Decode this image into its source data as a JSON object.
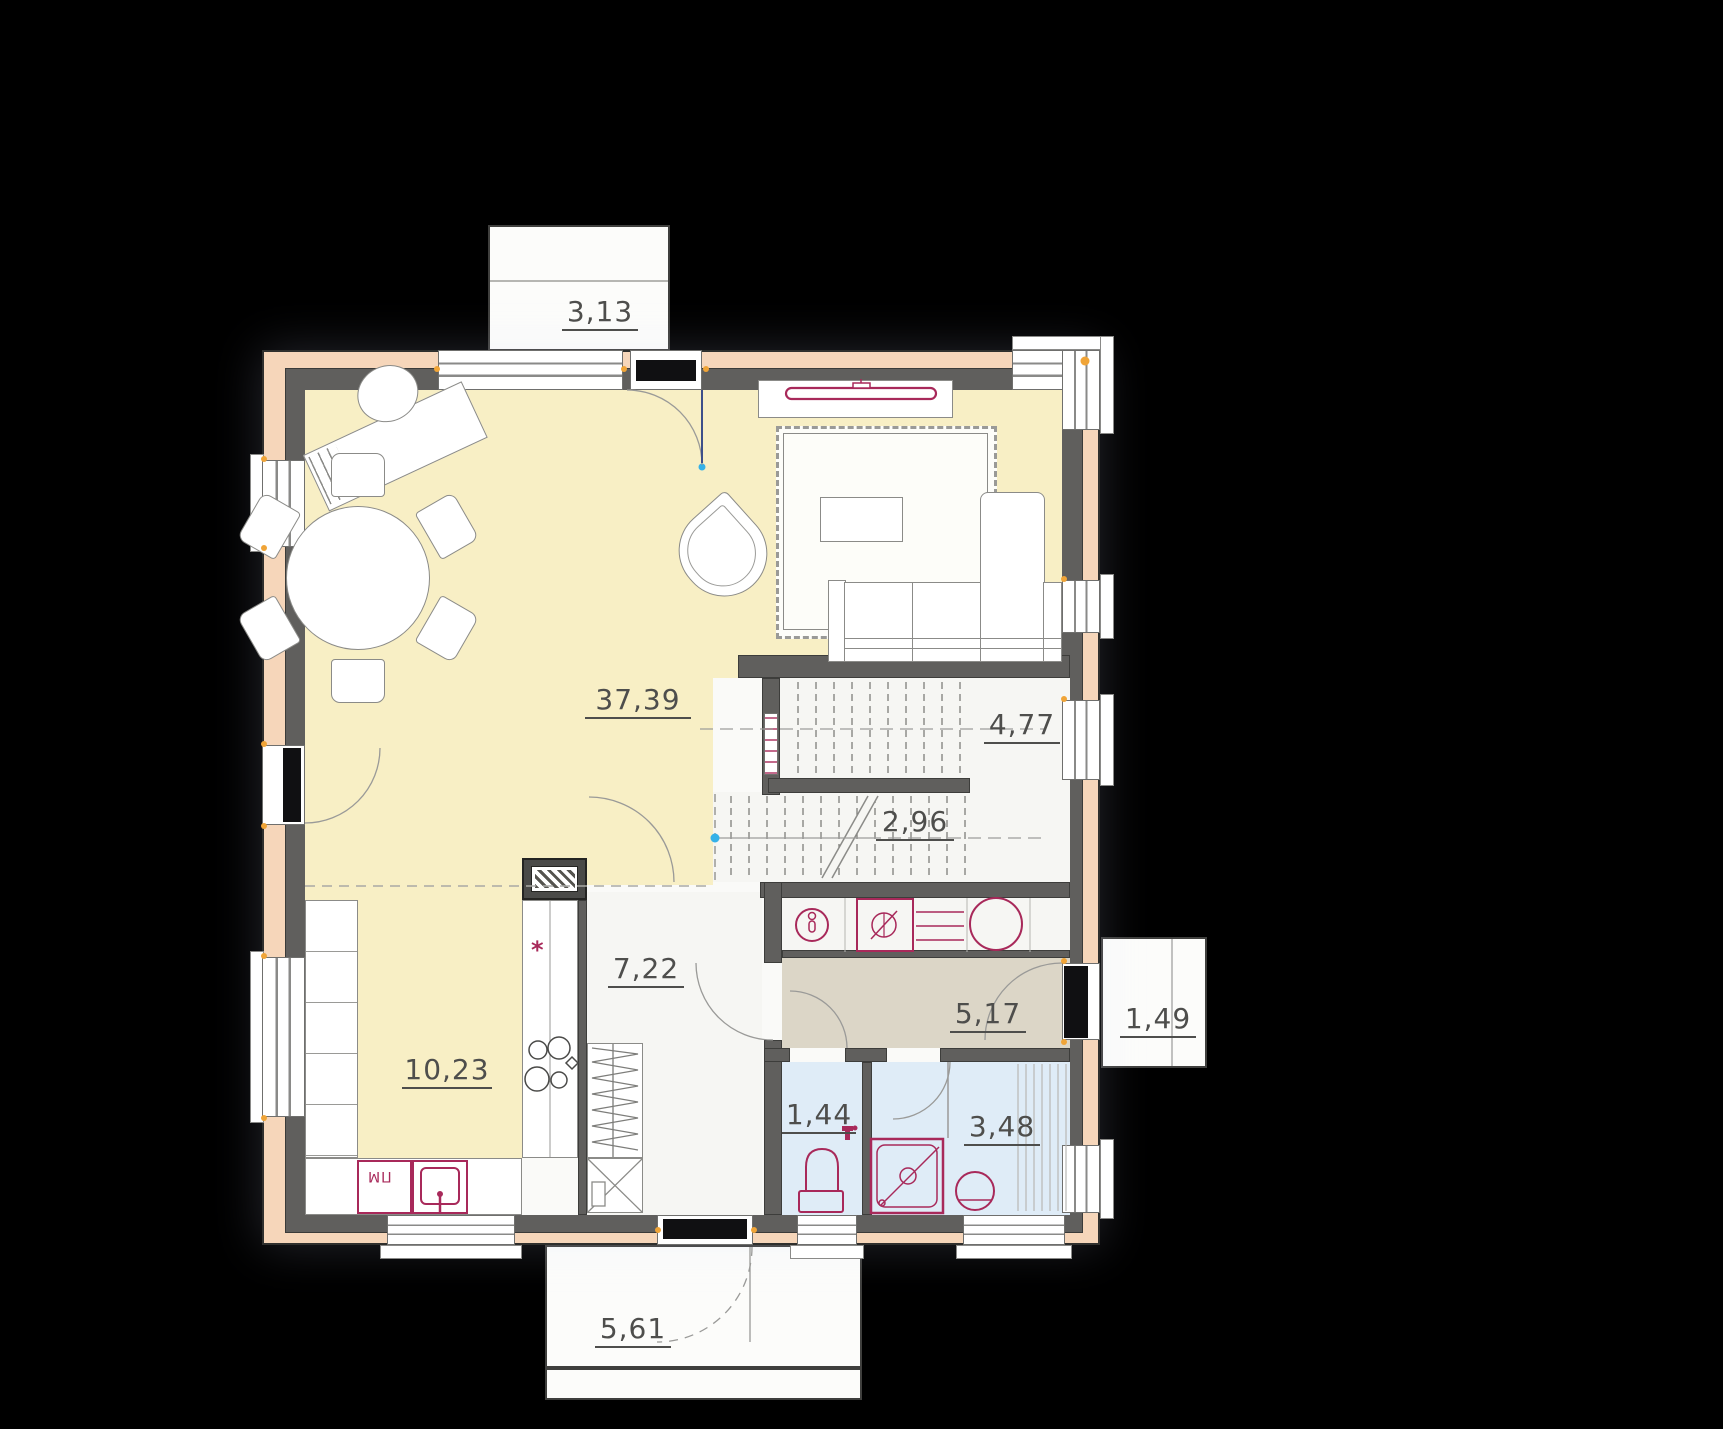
{
  "meta": {
    "type": "architectural-floor-plan",
    "level": "ground-floor",
    "units": "m2"
  },
  "rooms": {
    "terrace_top": {
      "name": "terrace",
      "area": "3,13"
    },
    "living": {
      "name": "living-dining-room",
      "area": "37,39"
    },
    "stairs_upper": {
      "name": "staircase-upper-flight",
      "area": "4,77"
    },
    "stairs_lower": {
      "name": "staircase-lower-flight",
      "area": "2,96"
    },
    "hallway": {
      "name": "hallway",
      "area": "7,22"
    },
    "kitchen": {
      "name": "kitchen",
      "area": "10,23"
    },
    "corridor": {
      "name": "entrance-corridor",
      "area": "5,17"
    },
    "wc": {
      "name": "wc",
      "area": "1,44"
    },
    "bathroom": {
      "name": "bathroom",
      "area": "3,48"
    },
    "porch_entry": {
      "name": "entry-porch",
      "area": "1,49"
    },
    "porch_garden": {
      "name": "garden-porch",
      "area": "5,61"
    }
  },
  "annotations": {
    "dishwasher_label": "ПМ",
    "stove_marker": "*"
  },
  "colors": {
    "background": "#000000",
    "wall": "#605f5d",
    "insulation": "#f6d6ba",
    "floor_main": "#f8efc5",
    "floor_service": "#f6f6f3",
    "floor_corridor": "#dcd6c7",
    "floor_bath": "#dfecf7",
    "fixture": "#a8295a",
    "accent_dot": "#35b1e8",
    "frame_dot": "#f0a437"
  },
  "icons": [
    "tv-icon",
    "sofa-icon",
    "armchair-icon",
    "rug-icon",
    "coffee-table-icon",
    "dining-table-icon",
    "dining-chair-icon",
    "desk-icon",
    "office-chair-icon",
    "stove-icon",
    "kitchen-sink-icon",
    "dishwasher-icon",
    "washing-machine-icon",
    "boiler-icon",
    "water-tank-icon",
    "shelf-icon",
    "toilet-icon",
    "shower-icon",
    "washbasin-icon",
    "faucet-icon",
    "wardrobe-icon",
    "shoe-cabinet-icon",
    "stairs-icon",
    "door-swing-icon",
    "window-icon",
    "chimney-icon"
  ]
}
